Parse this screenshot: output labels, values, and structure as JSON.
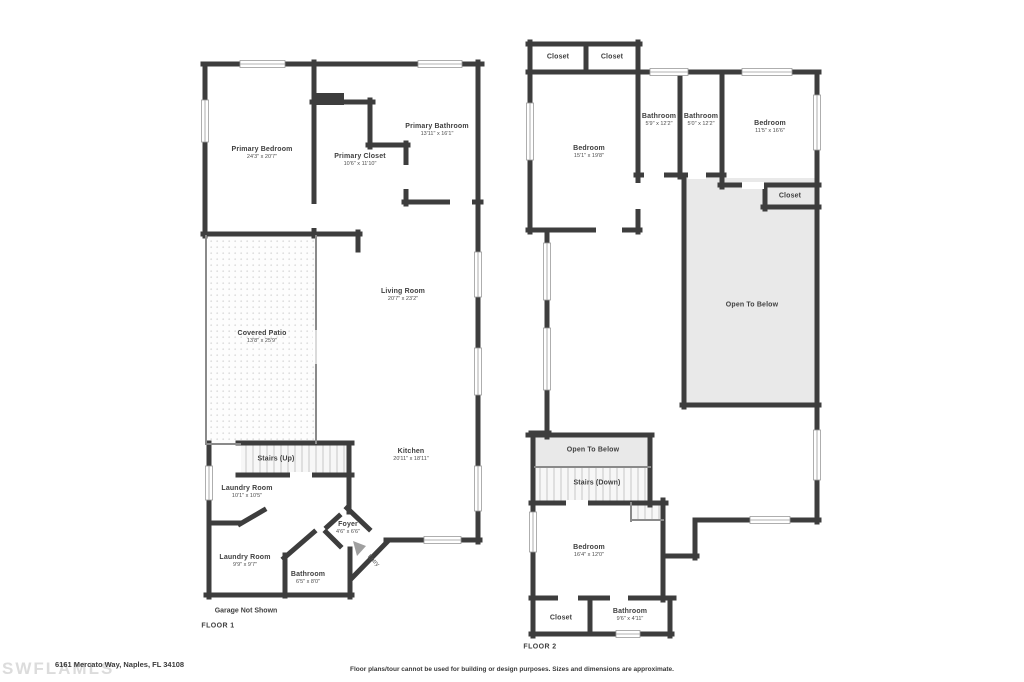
{
  "footer": {
    "address": "6161 Mercato Way, Naples, FL 34108",
    "disclaimer": "Floor plans/tour cannot be used for building or design purposes. Sizes and dimensions are approximate.",
    "watermark": "SWFLAMLS"
  },
  "colors": {
    "wall": "#3d3d3d",
    "open_to_below_fill": "#e9e9e9",
    "stairs_stripe": "#cfcfcf",
    "patio_dot": "#dedede",
    "label_text": "#3f3f3f",
    "watermark": "#dcdcdc"
  },
  "floor1": {
    "label": "FLOOR 1",
    "note": "Garage Not Shown",
    "entry_label": "Entry",
    "rooms": [
      {
        "name": "Primary Bedroom",
        "dims": "24'3\" x 20'7\""
      },
      {
        "name": "Primary Closet",
        "dims": "10'6\" x 11'10\""
      },
      {
        "name": "Primary Bathroom",
        "dims": "13'11\" x 16'1\""
      },
      {
        "name": "Living Room",
        "dims": "20'7\" x 23'2\""
      },
      {
        "name": "Covered Patio",
        "dims": "13'8\" x 25'9\""
      },
      {
        "name": "Stairs (Up)",
        "dims": ""
      },
      {
        "name": "Laundry Room",
        "dims": "10'1\" x 10'5\""
      },
      {
        "name": "Laundry Room",
        "dims": "9'9\" x 9'7\""
      },
      {
        "name": "Bathroom",
        "dims": "6'5\" x 8'0\""
      },
      {
        "name": "Kitchen",
        "dims": "20'11\" x 18'11\""
      },
      {
        "name": "Foyer",
        "dims": "4'6\" x 6'6\""
      }
    ]
  },
  "floor2": {
    "label": "FLOOR 2",
    "rooms": [
      {
        "name": "Closet",
        "dims": ""
      },
      {
        "name": "Closet",
        "dims": ""
      },
      {
        "name": "Bedroom",
        "dims": "15'1\" x 19'8\""
      },
      {
        "name": "Bathroom",
        "dims": "5'9\" x 12'2\""
      },
      {
        "name": "Bathroom",
        "dims": "5'0\" x 12'2\""
      },
      {
        "name": "Bedroom",
        "dims": "11'5\" x 16'6\""
      },
      {
        "name": "Closet",
        "dims": ""
      },
      {
        "name": "Open To Below",
        "dims": ""
      },
      {
        "name": "Open To Below",
        "dims": ""
      },
      {
        "name": "Stairs (Down)",
        "dims": ""
      },
      {
        "name": "Bedroom",
        "dims": "16'4\" x 12'0\""
      },
      {
        "name": "Closet",
        "dims": ""
      },
      {
        "name": "Bathroom",
        "dims": "9'6\" x 4'11\""
      }
    ]
  }
}
